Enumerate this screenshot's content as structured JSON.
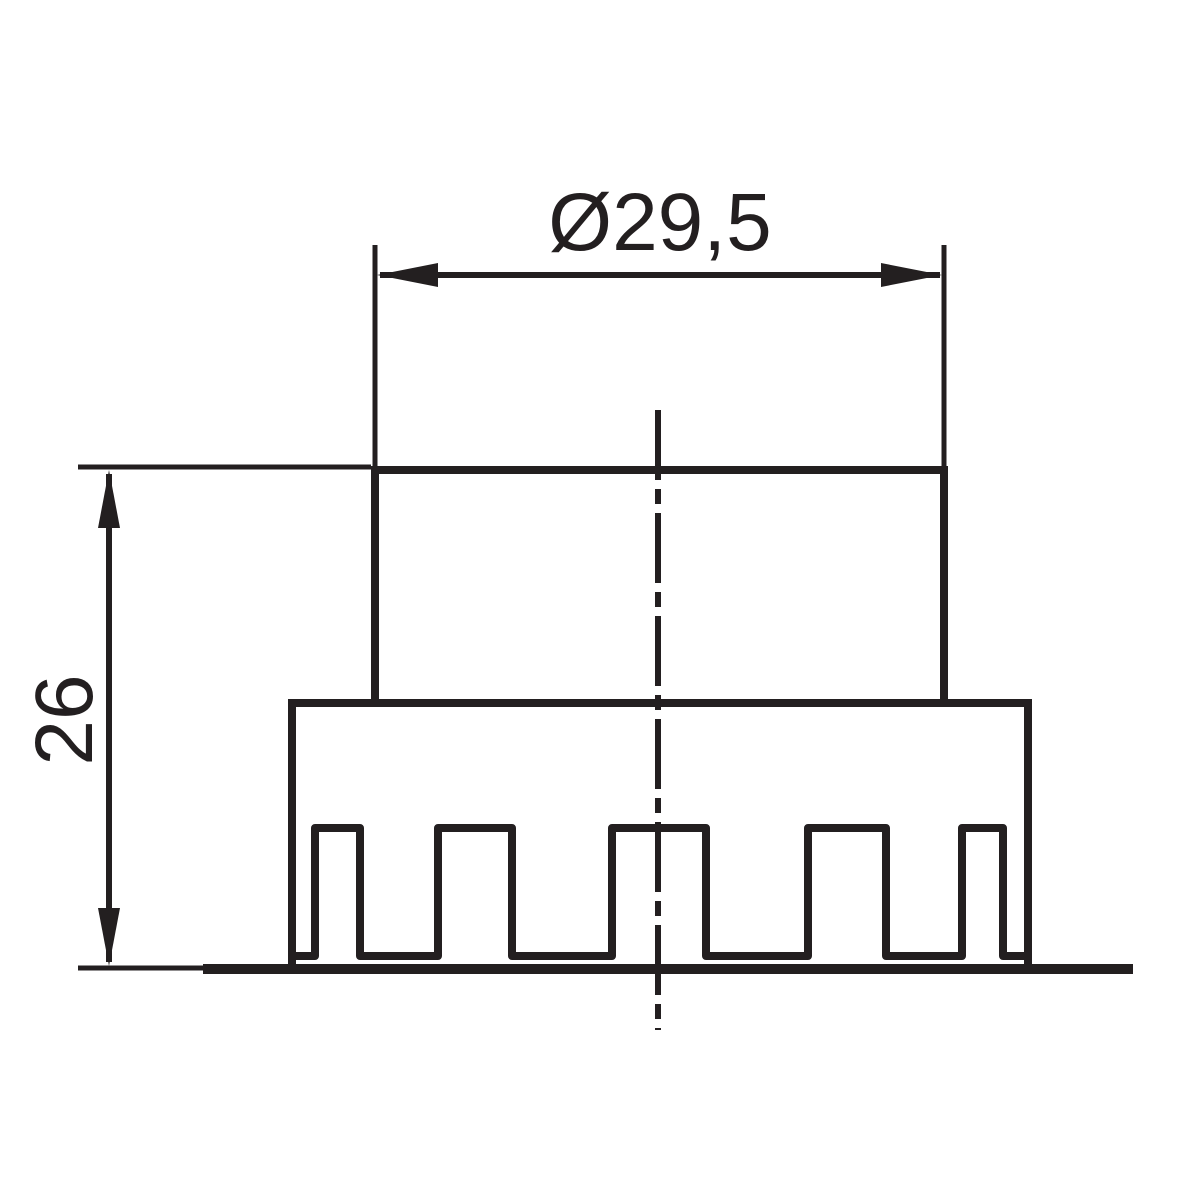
{
  "drawing": {
    "kind": "technical-dimension-drawing",
    "dimensions": {
      "diameter": {
        "label": "Ø29,5",
        "value": 29.5
      },
      "height": {
        "label": "26",
        "value": 26
      }
    },
    "colors": {
      "line": "#231f20",
      "background": "#ffffff"
    }
  }
}
